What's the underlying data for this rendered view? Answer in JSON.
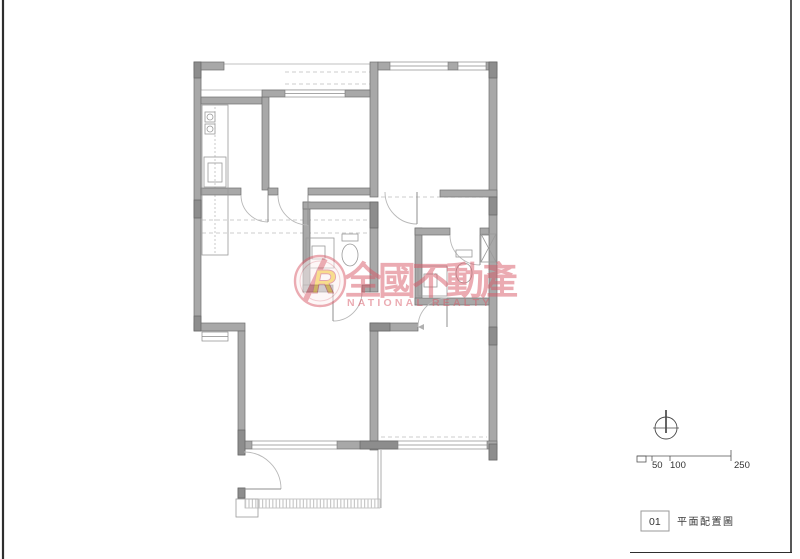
{
  "watermark": {
    "logo_letter": "R",
    "company_name_zh": "全國不動產",
    "company_name_en": "NATIONAL REALTY",
    "red": "#d85a68",
    "yellow": "#f2bc1e"
  },
  "drawing": {
    "wall_color": "#a8a8a8",
    "wall_dark_color": "#8d8d8d",
    "line_color": "#9a9a9a"
  },
  "scale_bar": {
    "labels": [
      "50",
      "100",
      "250"
    ]
  },
  "title_block": {
    "number": "01",
    "title": "平面配置圖"
  }
}
